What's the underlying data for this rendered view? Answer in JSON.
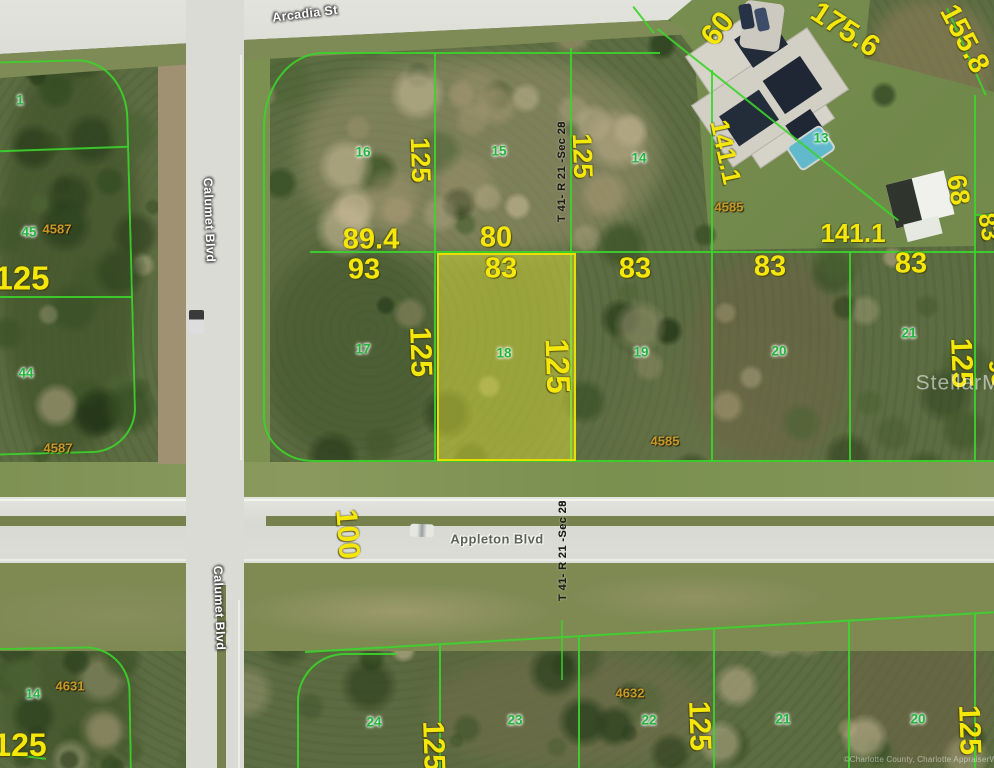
{
  "streets": [
    {
      "name": "Arcadia St",
      "x": 305,
      "y": 14,
      "rot": -7,
      "style": "light"
    },
    {
      "name": "Calumet Blvd",
      "x": 209,
      "y": 220,
      "rot": 88,
      "style": "light"
    },
    {
      "name": "Calumet Blvd",
      "x": 219,
      "y": 608,
      "rot": 88,
      "style": "light"
    },
    {
      "name": "Appleton Blvd",
      "x": 497,
      "y": 539,
      "rot": 0,
      "style": "dark"
    }
  ],
  "dimension_labels": [
    {
      "t": "175.6",
      "x": 845,
      "y": 30,
      "r": 33,
      "s": 30
    },
    {
      "t": "60",
      "x": 718,
      "y": 29,
      "r": -52,
      "s": 30
    },
    {
      "t": "155.8",
      "x": 964,
      "y": 39,
      "r": 62,
      "s": 29
    },
    {
      "t": "141.1",
      "x": 726,
      "y": 152,
      "r": 78,
      "s": 26
    },
    {
      "t": "141.1",
      "x": 853,
      "y": 233,
      "r": 0,
      "s": 26
    },
    {
      "t": "68",
      "x": 958,
      "y": 190,
      "r": 80,
      "s": 27
    },
    {
      "t": "83",
      "x": 988,
      "y": 227,
      "r": 80,
      "s": 25
    },
    {
      "t": "89.4",
      "x": 371,
      "y": 240,
      "r": 0,
      "s": 29
    },
    {
      "t": "80",
      "x": 496,
      "y": 238,
      "r": 0,
      "s": 29
    },
    {
      "t": "93",
      "x": 364,
      "y": 270,
      "r": 0,
      "s": 29
    },
    {
      "t": "83",
      "x": 501,
      "y": 269,
      "r": 0,
      "s": 29
    },
    {
      "t": "83",
      "x": 635,
      "y": 269,
      "r": 0,
      "s": 29
    },
    {
      "t": "83",
      "x": 770,
      "y": 267,
      "r": 0,
      "s": 29
    },
    {
      "t": "83",
      "x": 911,
      "y": 264,
      "r": 0,
      "s": 29
    },
    {
      "t": "125",
      "x": 420,
      "y": 160,
      "r": 88,
      "s": 27
    },
    {
      "t": "125",
      "x": 582,
      "y": 156,
      "r": 88,
      "s": 27
    },
    {
      "t": "125",
      "x": 420,
      "y": 352,
      "r": 88,
      "s": 30
    },
    {
      "t": "125",
      "x": 558,
      "y": 366,
      "r": 88,
      "s": 33
    },
    {
      "t": "125",
      "x": 961,
      "y": 363,
      "r": 88,
      "s": 30
    },
    {
      "t": "98",
      "x": 998,
      "y": 373,
      "r": 80,
      "s": 25
    },
    {
      "t": "125",
      "x": 22,
      "y": 278,
      "r": 0,
      "s": 33
    },
    {
      "t": "100",
      "x": 347,
      "y": 534,
      "r": 86,
      "s": 30
    },
    {
      "t": "125",
      "x": 433,
      "y": 746,
      "r": 88,
      "s": 30
    },
    {
      "t": "125",
      "x": 699,
      "y": 726,
      "r": 88,
      "s": 30
    },
    {
      "t": "125",
      "x": 969,
      "y": 730,
      "r": 88,
      "s": 30
    },
    {
      "t": "125",
      "x": 20,
      "y": 745,
      "r": 0,
      "s": 32
    }
  ],
  "lot_numbers": [
    {
      "t": "1",
      "x": 20,
      "y": 100
    },
    {
      "t": "45",
      "x": 29,
      "y": 232
    },
    {
      "t": "44",
      "x": 26,
      "y": 373
    },
    {
      "t": "16",
      "x": 363,
      "y": 152
    },
    {
      "t": "15",
      "x": 499,
      "y": 151
    },
    {
      "t": "14",
      "x": 639,
      "y": 158
    },
    {
      "t": "13",
      "x": 821,
      "y": 138
    },
    {
      "t": "17",
      "x": 363,
      "y": 349
    },
    {
      "t": "18",
      "x": 504,
      "y": 353
    },
    {
      "t": "19",
      "x": 641,
      "y": 352
    },
    {
      "t": "20",
      "x": 779,
      "y": 351
    },
    {
      "t": "21",
      "x": 909,
      "y": 333
    },
    {
      "t": "14",
      "x": 33,
      "y": 694
    },
    {
      "t": "24",
      "x": 374,
      "y": 722
    },
    {
      "t": "23",
      "x": 515,
      "y": 720
    },
    {
      "t": "22",
      "x": 649,
      "y": 720
    },
    {
      "t": "21",
      "x": 783,
      "y": 719
    },
    {
      "t": "20",
      "x": 918,
      "y": 719
    }
  ],
  "block_numbers": [
    {
      "t": "4587",
      "x": 57,
      "y": 229
    },
    {
      "t": "4587",
      "x": 58,
      "y": 448
    },
    {
      "t": "4585",
      "x": 729,
      "y": 207
    },
    {
      "t": "4585",
      "x": 665,
      "y": 441
    },
    {
      "t": "4631",
      "x": 70,
      "y": 686
    },
    {
      "t": "4632",
      "x": 630,
      "y": 693
    }
  ],
  "section_labels": [
    {
      "line1": "T 41- R 21 -Sec 29",
      "line2": "T 41- R 21 -Sec 28",
      "x": 557,
      "y": 222
    },
    {
      "line1": "T 41- R 21 -Sec 29",
      "line2": "T 41- R 21 -Sec 28",
      "x": 558,
      "y": 601
    }
  ],
  "highlighted_lot": {
    "lot": "18"
  },
  "watermark": "StellarMLS",
  "copyright": "©Charlotte County, Charlotte AppraiserWeb",
  "colors": {
    "parcel_line": "#3cd42c",
    "dimension_text": "#f6e70a",
    "lot_number_text": "#21b53c",
    "block_number_text": "#c8992a",
    "highlight_fill": "rgba(236,236,60,0.45)",
    "highlight_border": "#e8df00"
  }
}
